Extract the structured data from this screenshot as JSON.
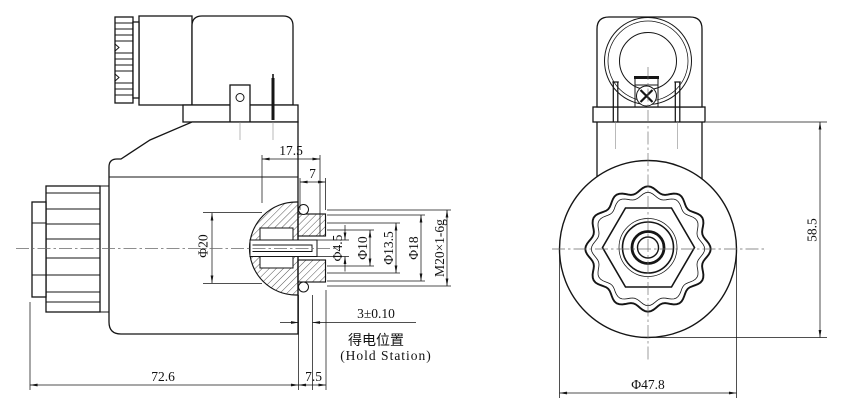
{
  "doc": {
    "type": "technical-drawing",
    "subject": "solenoid-coil-two-view-drawing"
  },
  "side_view": {
    "dims": {
      "top_offset": "17.5",
      "nut_width": "7",
      "coil_bore_dia": "Φ20",
      "pin_dia": "Φ4.5",
      "bore_dia": "Φ10",
      "tube_dia": "Φ13.5",
      "shoulder_dia": "Φ18",
      "thread_spec": "M20×1-6g",
      "stroke": "3±0.10",
      "stroke_note_cn": "得电位置",
      "stroke_note_en": "(Hold Station)",
      "overall_length": "72.6",
      "nut_overhang": "7.5"
    }
  },
  "front_view": {
    "dims": {
      "overall_height": "58.5",
      "coil_outer_dia": "Φ47.8"
    }
  },
  "colors": {
    "line": "#151515",
    "background": "#ffffff"
  }
}
